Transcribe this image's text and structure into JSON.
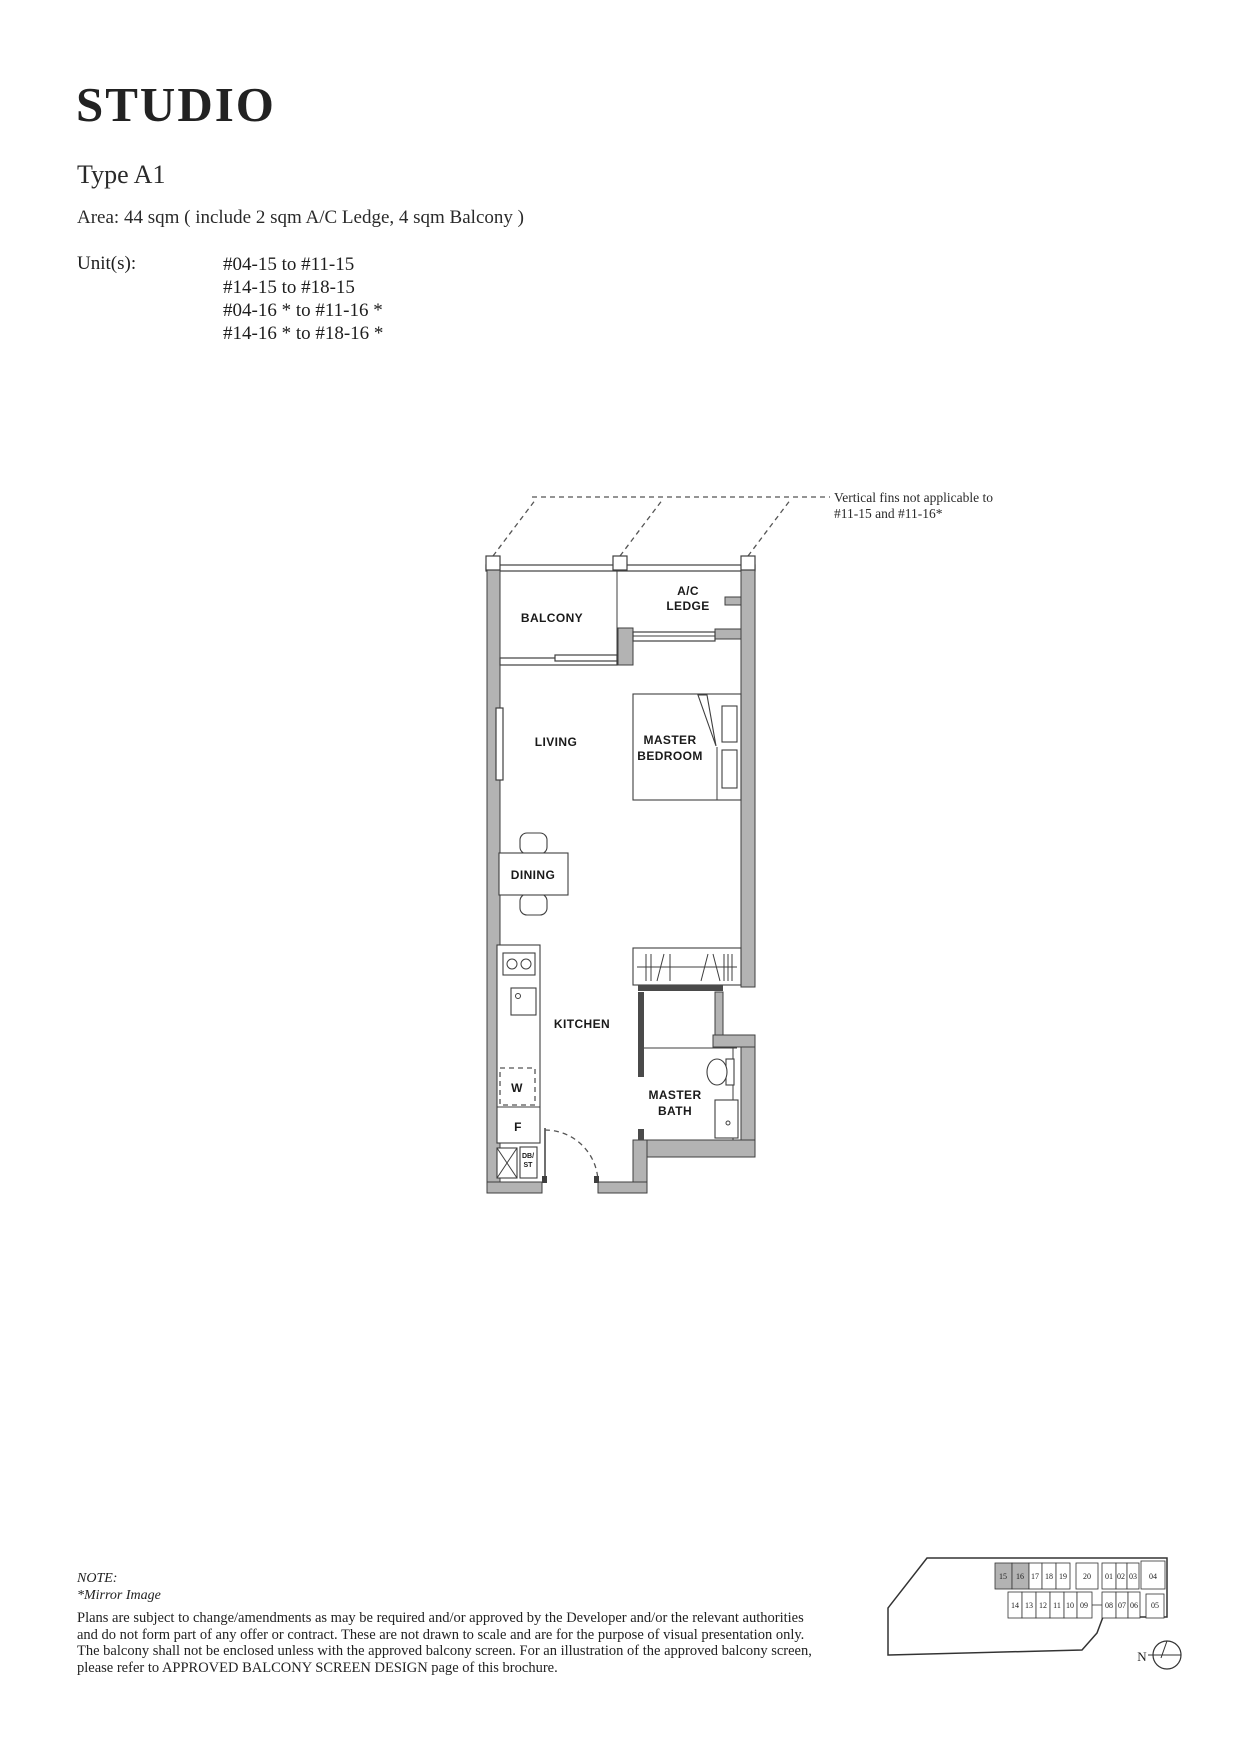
{
  "header": {
    "title": "STUDIO",
    "type_label": "Type A1",
    "area_line": "Area: 44 sqm ( include 2 sqm A/C Ledge, 4 sqm Balcony )",
    "units_label": "Unit(s):",
    "units": [
      "#04-15 to #11-15",
      "#14-15 to #18-15",
      "#04-16 * to #11-16 *",
      "#14-16 * to #18-16 *"
    ]
  },
  "floorplan": {
    "annotation_line1": "Vertical fins not applicable to",
    "annotation_line2": "#11-15 and #11-16*",
    "labels": {
      "balcony": "BALCONY",
      "ac_ledge_1": "A/C",
      "ac_ledge_2": "LEDGE",
      "living": "LIVING",
      "master_bedroom_1": "MASTER",
      "master_bedroom_2": "BEDROOM",
      "dining": "DINING",
      "kitchen": "KITCHEN",
      "master_bath_1": "MASTER",
      "master_bath_2": "BATH",
      "washer": "W",
      "fridge": "F",
      "db_1": "DB/",
      "db_2": "ST"
    },
    "colors": {
      "wall_gray": "#b3b3b3",
      "line": "#3f3f3f",
      "dash": "#555555"
    }
  },
  "note": {
    "label": "NOTE:",
    "mirror": "*Mirror Image",
    "disclaimer": [
      "Plans are subject to change/amendments as may be required and/or approved by the Developer and/or the relevant authorities",
      "and do not form part of any offer or contract. These are not drawn to scale and are for the purpose of visual presentation only.",
      "The balcony shall not be enclosed unless with the approved balcony screen. For an illustration of the approved balcony screen,",
      "please refer to APPROVED BALCONY SCREEN DESIGN page of this brochure."
    ]
  },
  "keyplan": {
    "north_label": "N",
    "highlight_color": "#b3b3b3",
    "top_row": [
      {
        "label": "15",
        "highlight": true
      },
      {
        "label": "16",
        "highlight": true
      },
      {
        "label": "17",
        "highlight": false
      },
      {
        "label": "18",
        "highlight": false
      },
      {
        "label": "19",
        "highlight": false
      },
      {
        "label": "20",
        "highlight": false
      },
      {
        "label": "01",
        "highlight": false
      },
      {
        "label": "02",
        "highlight": false
      },
      {
        "label": "03",
        "highlight": false
      },
      {
        "label": "04",
        "highlight": false
      }
    ],
    "bottom_row": [
      {
        "label": "14",
        "highlight": false
      },
      {
        "label": "13",
        "highlight": false
      },
      {
        "label": "12",
        "highlight": false
      },
      {
        "label": "11",
        "highlight": false
      },
      {
        "label": "10",
        "highlight": false
      },
      {
        "label": "09",
        "highlight": false
      },
      {
        "label": "08",
        "highlight": false
      },
      {
        "label": "07",
        "highlight": false
      },
      {
        "label": "06",
        "highlight": false
      },
      {
        "label": "05",
        "highlight": false
      }
    ]
  }
}
